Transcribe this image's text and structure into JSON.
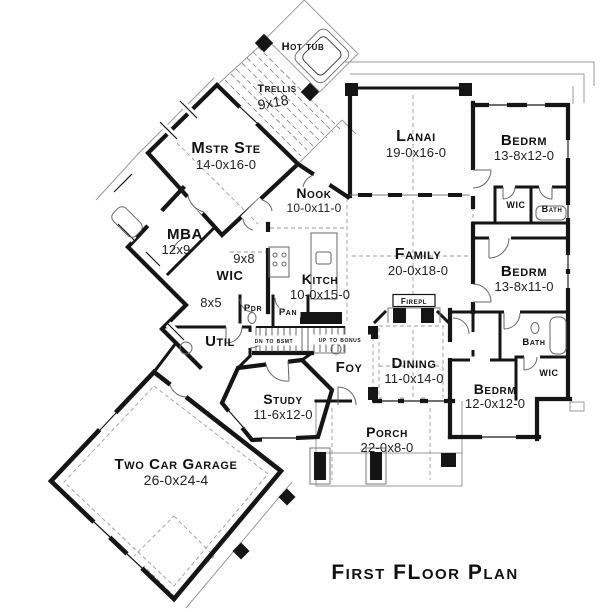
{
  "title": "First FLoor Plan",
  "colors": {
    "wall": "#151515",
    "thin_line": "#999999",
    "text": "#111111",
    "background": "#ffffff"
  },
  "rooms": [
    {
      "id": "hot-tub",
      "label": "Hot tub",
      "x": 303,
      "y": 50,
      "s": 11
    },
    {
      "id": "trellis",
      "label": "Trellis",
      "x": 277,
      "y": 92,
      "s": 11
    },
    {
      "id": "trellis-dims",
      "label": "9x18",
      "x": 274,
      "y": 107,
      "s": 14,
      "cls": "plain",
      "rot": -10
    },
    {
      "id": "mstr-ste",
      "label": "Mstr Ste",
      "dims": "14-0x16-0",
      "x": 226,
      "y": 153,
      "s": 16,
      "ds": 13,
      "dy": 16
    },
    {
      "id": "lanai",
      "label": "Lanai",
      "dims": "19-0x16-0",
      "x": 416,
      "y": 141,
      "s": 16,
      "ds": 13,
      "dy": 16
    },
    {
      "id": "bedrm-1",
      "label": "Bedrm",
      "dims": "13-8x12-0",
      "x": 524,
      "y": 145,
      "s": 15,
      "ds": 13,
      "dy": 15
    },
    {
      "id": "nook",
      "label": "Nook",
      "dims": "10-0x11-0",
      "x": 314,
      "y": 198,
      "s": 14,
      "ds": 12,
      "dy": 14
    },
    {
      "id": "wic-1",
      "label": "WIC",
      "x": 516,
      "y": 208,
      "s": 9
    },
    {
      "id": "bath-1",
      "label": "Bath",
      "x": 552,
      "y": 212,
      "s": 9
    },
    {
      "id": "mba",
      "label": "MBA",
      "dims": "12x9",
      "x": 185,
      "y": 239,
      "s": 15,
      "ds": 13,
      "dy": 15,
      "dx": -9
    },
    {
      "id": "hall-9x8",
      "label": "9x8",
      "x": 244,
      "y": 263,
      "s": 13,
      "cls": "plain"
    },
    {
      "id": "family",
      "label": "Family",
      "dims": "20-0x18-0",
      "x": 418,
      "y": 259,
      "s": 16,
      "ds": 13,
      "dy": 16
    },
    {
      "id": "kitch",
      "label": "Kitch",
      "dims": "10-0x15-0",
      "x": 320,
      "y": 284,
      "s": 14,
      "ds": 13,
      "dy": 15
    },
    {
      "id": "wic-2",
      "label": "WIC",
      "x": 230,
      "y": 280,
      "s": 13
    },
    {
      "id": "wic-2-dims",
      "label": "8x5",
      "x": 211,
      "y": 307,
      "s": 13,
      "cls": "plain"
    },
    {
      "id": "bedrm-2",
      "label": "Bedrm",
      "dims": "13-8x11-0",
      "x": 524,
      "y": 276,
      "s": 15,
      "ds": 13,
      "dy": 15
    },
    {
      "id": "firepl",
      "label": "Firepl",
      "x": 414,
      "y": 304,
      "s": 8,
      "bg": {
        "w": 42,
        "h": 12,
        "box": true
      }
    },
    {
      "id": "pdr",
      "label": "Pdr",
      "x": 253,
      "y": 311,
      "s": 9.5
    },
    {
      "id": "pan",
      "label": "Pan",
      "x": 288,
      "y": 315,
      "s": 9.5,
      "bg": {
        "w": 25,
        "h": 10
      }
    },
    {
      "id": "util",
      "label": "Util",
      "x": 220,
      "y": 346,
      "s": 15
    },
    {
      "id": "dn-to-bsmt",
      "label": "dn to bsmt",
      "x": 274,
      "y": 343,
      "s": 7.5,
      "bg": {
        "w": 55,
        "h": 10
      }
    },
    {
      "id": "up-to-bonus",
      "label": "up to bonus",
      "x": 340,
      "y": 342,
      "s": 7.5,
      "bg": {
        "w": 62,
        "h": 10
      }
    },
    {
      "id": "bath-2",
      "label": "Bath",
      "x": 534,
      "y": 345,
      "s": 9.5
    },
    {
      "id": "foy",
      "label": "Foy",
      "x": 349,
      "y": 372,
      "s": 15
    },
    {
      "id": "dining",
      "label": "Dining",
      "dims": "11-0x14-0",
      "x": 414,
      "y": 368,
      "s": 15,
      "ds": 13,
      "dy": 15
    },
    {
      "id": "wic-3",
      "label": "WIC",
      "x": 549,
      "y": 376,
      "s": 9
    },
    {
      "id": "bedrm-3",
      "label": "Bedrm",
      "dims": "12-0x12-0",
      "x": 495,
      "y": 394,
      "s": 14,
      "ds": 13,
      "dy": 14
    },
    {
      "id": "study",
      "label": "Study",
      "dims": "11-6x12-0",
      "x": 283,
      "y": 404,
      "s": 14,
      "ds": 13,
      "dy": 15
    },
    {
      "id": "porch",
      "label": "Porch",
      "dims": "22-0x8-0",
      "x": 387,
      "y": 437,
      "s": 14,
      "ds": 13,
      "dy": 15
    },
    {
      "id": "garage",
      "label": "Two Car Garage",
      "dims": "26-0x24-4",
      "x": 176,
      "y": 469,
      "s": 15,
      "ds": 14,
      "dy": 16
    }
  ]
}
